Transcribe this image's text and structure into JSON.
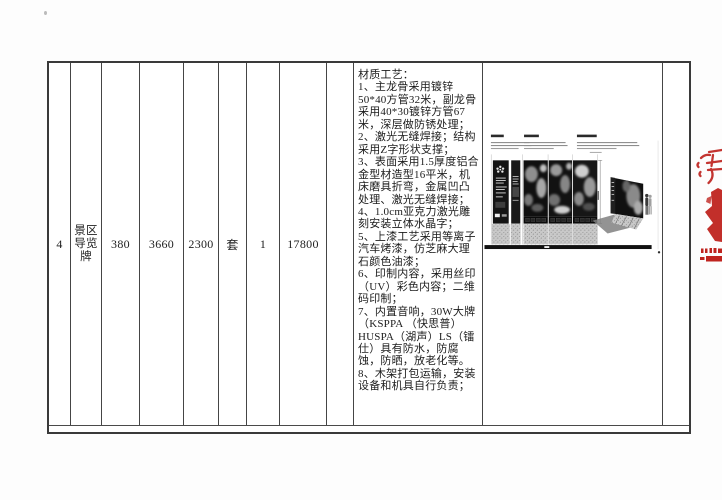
{
  "table": {
    "row": {
      "seq": "4",
      "item_name": "景区导览牌",
      "dim_width": "380",
      "dim_height": "3660",
      "dim_depth": "2300",
      "unit": "套",
      "quantity": "1",
      "amount": "17800",
      "spec": "材质工艺：\n1、主龙骨采用镀锌50*40方管32米，副龙骨采用40*30镀锌方管67米，深层做防锈处理；\n2、激光无缝焊接；结构采用Z字形状支撑；\n3、表面采用1.5厚度铝合金型材造型16平米，机床磨具折弯，金属凹凸处理、激光无缝焊接；\n4、1.0cm亚克力激光雕刻安装立体水晶字；\n5、上漆工艺采用等离子汽车烤漆，仿芝麻大理石颜色油漆；\n6、印制内容，采用丝印（UV）彩色内容；二维码印制；\n7、内置音响，30W大牌（KSPPA （快思普）HUSPA（湖声）LS（镭仕）具有防水，防腐蚀，防晒，放老化等。\n8、木架打包运输，安装设备和机具自行负责；"
    }
  },
  "colors": {
    "seal_red": "#bf241f",
    "table_border": "#3a3a3a",
    "ink": "#1e1e1e"
  }
}
